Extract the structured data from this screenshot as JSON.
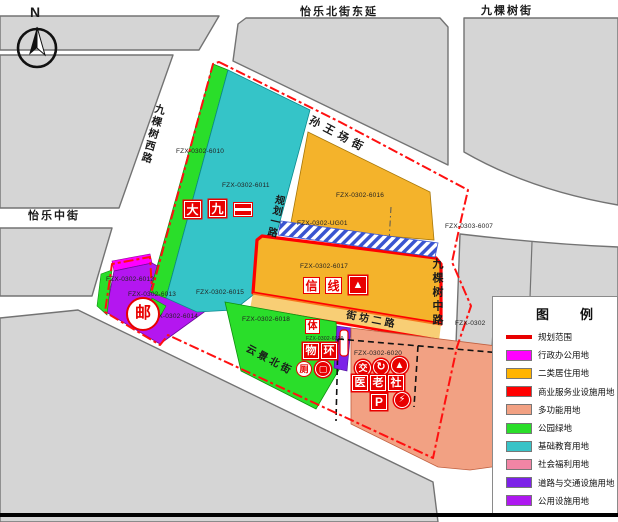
{
  "compass": {
    "label": "N"
  },
  "streets": {
    "yile_bei_ext": "怡乐北街东延",
    "jiukeshu_jie": "九棵树街",
    "jiukeshu_xi_lu": "九棵树西路",
    "yile_zhong_jie": "怡乐中街",
    "sunwangchang_jie": "孙王场街",
    "guihua_yi_lu": "规划一路",
    "jiukeshu_zhong_lu": "九棵树中路",
    "jiefang_er_lu": "街坊二路",
    "yunjing_bei_jie": "云景北街"
  },
  "parcels": {
    "p6010": "FZX-0302-6010",
    "p6011": "FZX-0302-6011",
    "p6016": "FZX-0302-6016",
    "ug01": "FZX-0302-UG01",
    "p6017": "FZX-0302-6017",
    "p6015": "FZX-0302-6015",
    "p6018": "FZX-0302-6018",
    "p6019": "FZX-0302-6019",
    "p6012": "FZX-0302-6012",
    "p6013": "FZX-0302-6013",
    "p6014": "FZX-0302-6014",
    "p6020": "FZX-0302-6020",
    "p6007": "FZX-0303-6007",
    "p0302_partial": "FZX-0302"
  },
  "symbols": {
    "da": "大",
    "jiu": "九",
    "xin": "信",
    "xian": "线",
    "ti": "体",
    "wu": "物",
    "huan": "环",
    "ce": "厕",
    "you": "邮",
    "jiao": "交",
    "yi": "医",
    "lao": "老",
    "she": "社",
    "parking": "P"
  },
  "icon_glyphs": {
    "triangle": "▲",
    "arrow": "↻",
    "bolt": "⚡",
    "box": "▢"
  },
  "legend": {
    "title": "图　例",
    "items": [
      {
        "label": "规划范围",
        "color": "#FF0000"
      },
      {
        "label": "行政办公用地",
        "color": "#FF00FF"
      },
      {
        "label": "二类居住用地",
        "color": "#FFB400"
      },
      {
        "label": "商业服务业设施用地",
        "color": "#FF0000"
      },
      {
        "label": "多功能用地",
        "color": "#F2A183"
      },
      {
        "label": "公园绿地",
        "color": "#2ADE2A"
      },
      {
        "label": "基础教育用地",
        "color": "#38C3C7"
      },
      {
        "label": "社会福利用地",
        "color": "#F285A5"
      },
      {
        "label": "道路与交通设施用地",
        "color": "#7C22E8"
      },
      {
        "label": "公用设施用地",
        "color": "#AE18F0"
      }
    ]
  },
  "colors": {
    "boundary": "#FF1010",
    "city_block": "#D5D5D5",
    "residential_orange": "#F4B32B",
    "education_cyan": "#35C4C8",
    "park_green": "#2ADE2A",
    "utilities_purple": "#B416F0",
    "multi_use_salmon": "#F2A183",
    "symbol_red": "#E80000"
  }
}
